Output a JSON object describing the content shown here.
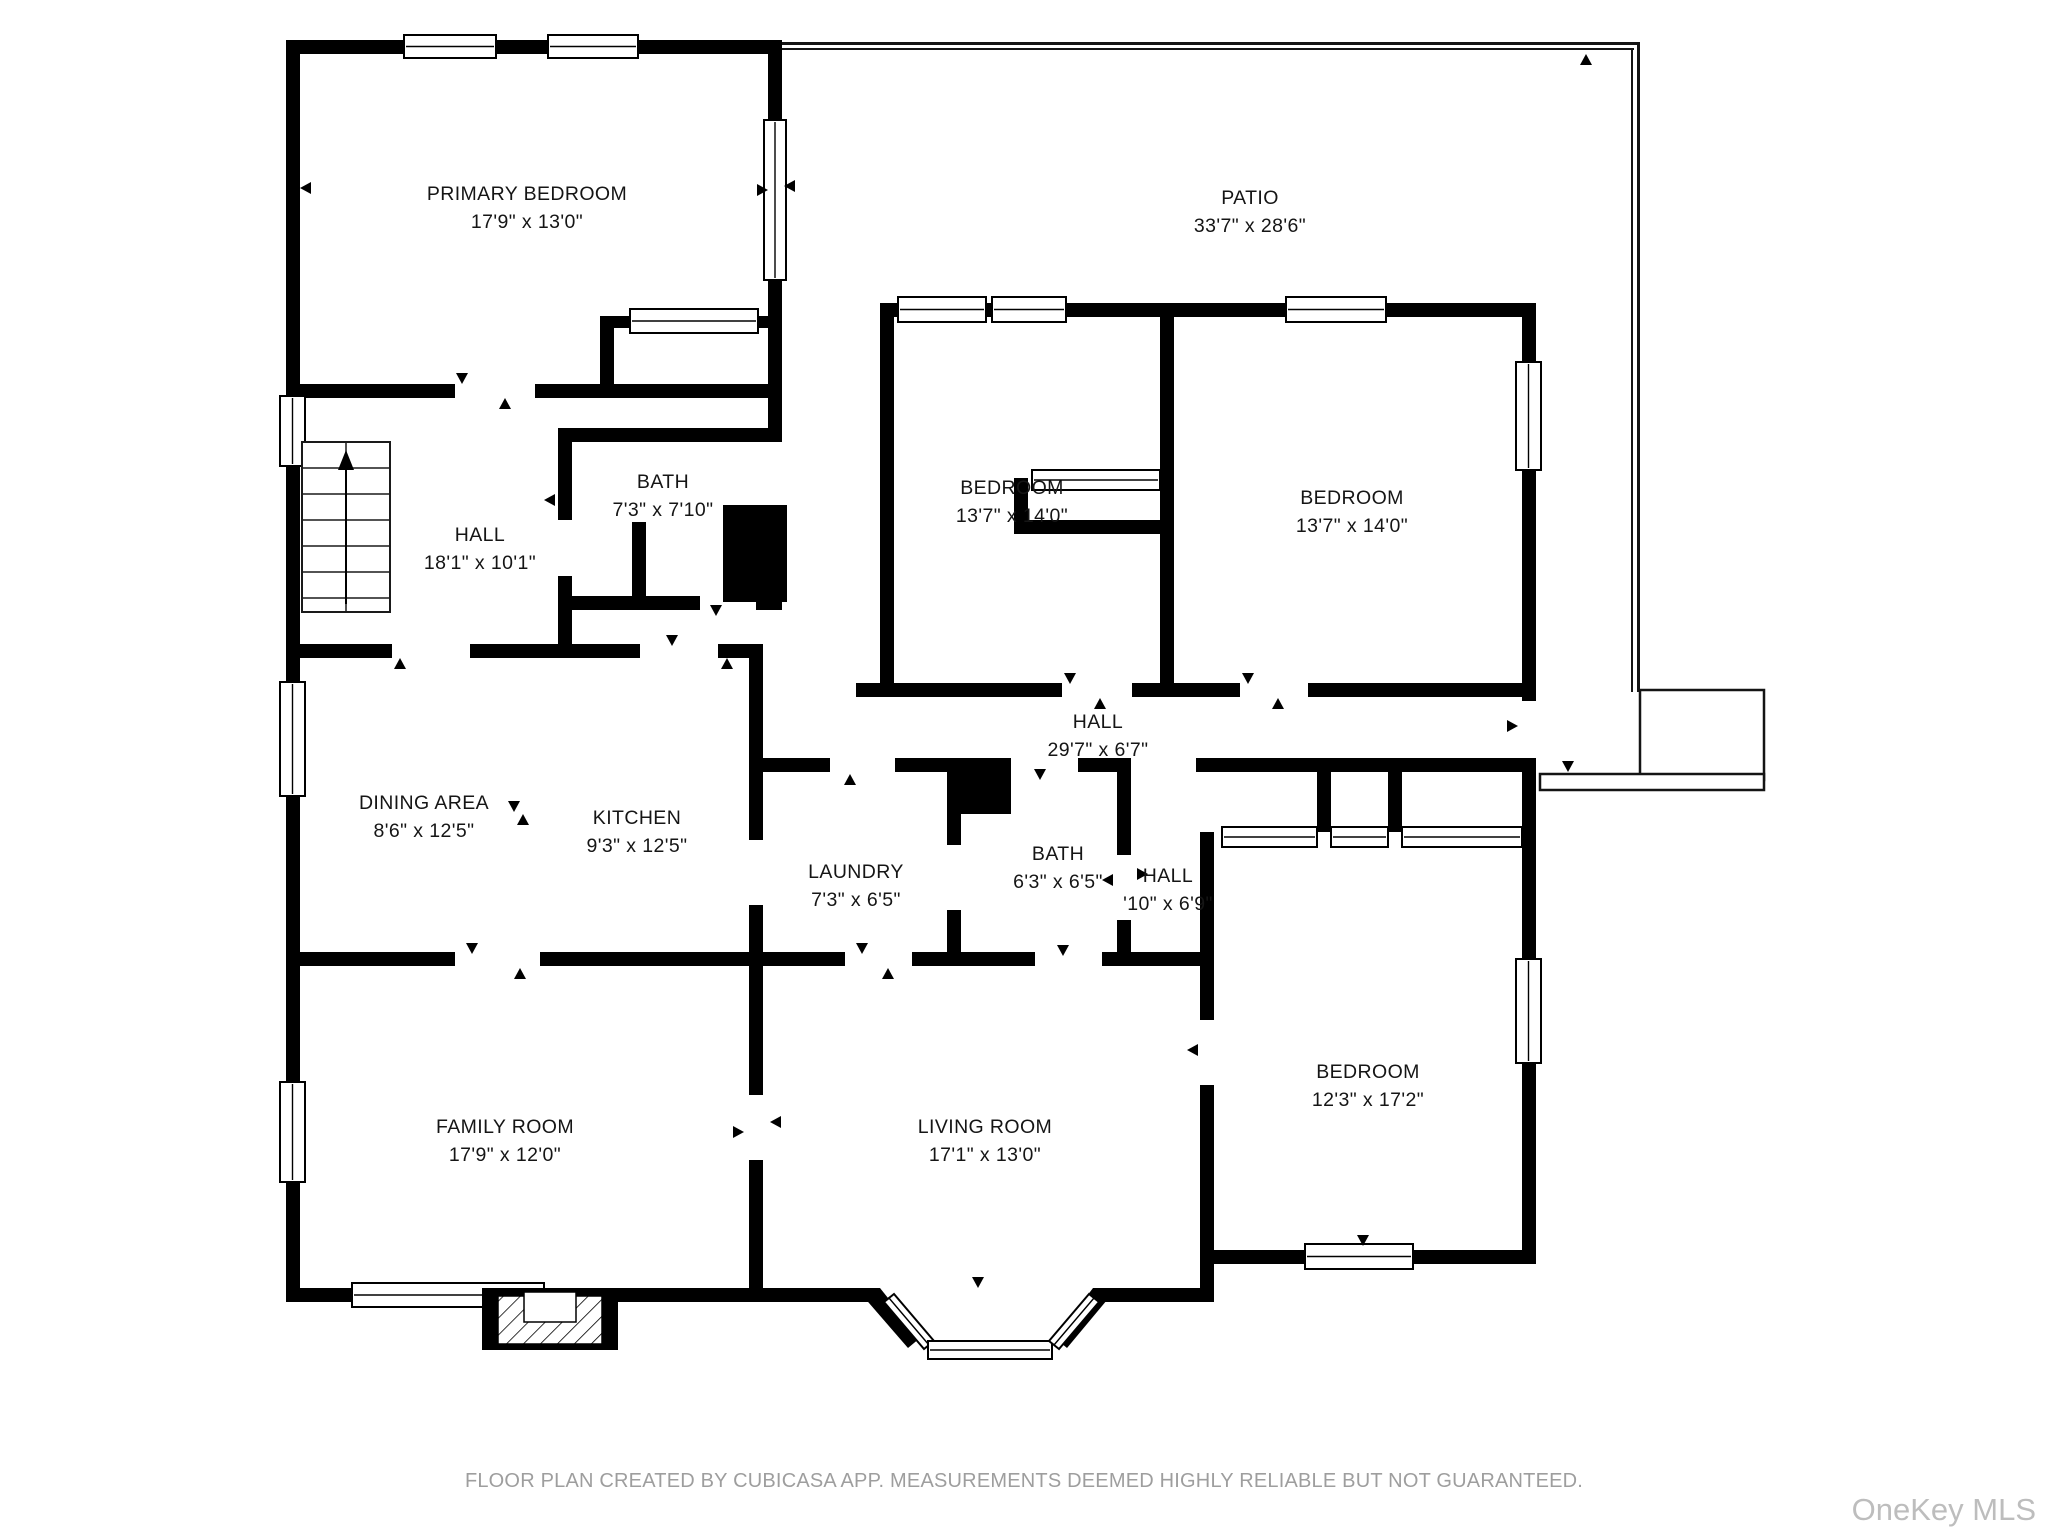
{
  "floorplan": {
    "footer": "FLOOR PLAN CREATED BY CUBICASA APP. MEASUREMENTS DEEMED HIGHLY RELIABLE BUT NOT GUARANTEED.",
    "watermark": "OneKey MLS",
    "colors": {
      "walls": "#000000",
      "background": "#ffffff",
      "footer_text": "#9e9e9e",
      "watermark_text": "#bdbdbd"
    },
    "rooms": [
      {
        "name": "PRIMARY BEDROOM",
        "dims": "17'9\" x 13'0\"",
        "cx": 527,
        "ny": 194,
        "dy": 222
      },
      {
        "name": "PATIO",
        "dims": "33'7\" x 28'6\"",
        "cx": 1250,
        "ny": 198,
        "dy": 226
      },
      {
        "name": "BATH",
        "dims": "7'3\" x 7'10\"",
        "cx": 663,
        "ny": 482,
        "dy": 510
      },
      {
        "name": "HALL",
        "dims": "18'1\" x 10'1\"",
        "cx": 480,
        "ny": 535,
        "dy": 563
      },
      {
        "name": "BEDROOM",
        "dims": "13'7\" x 14'0\"",
        "cx": 1012,
        "ny": 488,
        "dy": 516
      },
      {
        "name": "BEDROOM",
        "dims": "13'7\" x 14'0\"",
        "cx": 1352,
        "ny": 498,
        "dy": 526
      },
      {
        "name": "HALL",
        "dims": "29'7\" x 6'7\"",
        "cx": 1098,
        "ny": 722,
        "dy": 750
      },
      {
        "name": "DINING AREA",
        "dims": "8'6\" x 12'5\"",
        "cx": 424,
        "ny": 803,
        "dy": 831
      },
      {
        "name": "KITCHEN",
        "dims": "9'3\" x 12'5\"",
        "cx": 637,
        "ny": 818,
        "dy": 846
      },
      {
        "name": "LAUNDRY",
        "dims": "7'3\" x 6'5\"",
        "cx": 856,
        "ny": 872,
        "dy": 900
      },
      {
        "name": "BATH",
        "dims": "6'3\" x 6'5\"",
        "cx": 1058,
        "ny": 854,
        "dy": 882
      },
      {
        "name": "HALL",
        "dims": "'10\" x 6'9\"",
        "cx": 1168,
        "ny": 876,
        "dy": 904
      },
      {
        "name": "FAMILY ROOM",
        "dims": "17'9\" x 12'0\"",
        "cx": 505,
        "ny": 1127,
        "dy": 1155
      },
      {
        "name": "LIVING ROOM",
        "dims": "17'1\" x 13'0\"",
        "cx": 985,
        "ny": 1127,
        "dy": 1155
      },
      {
        "name": "BEDROOM",
        "dims": "12'3\" x 17'2\"",
        "cx": 1368,
        "ny": 1072,
        "dy": 1100
      }
    ]
  }
}
